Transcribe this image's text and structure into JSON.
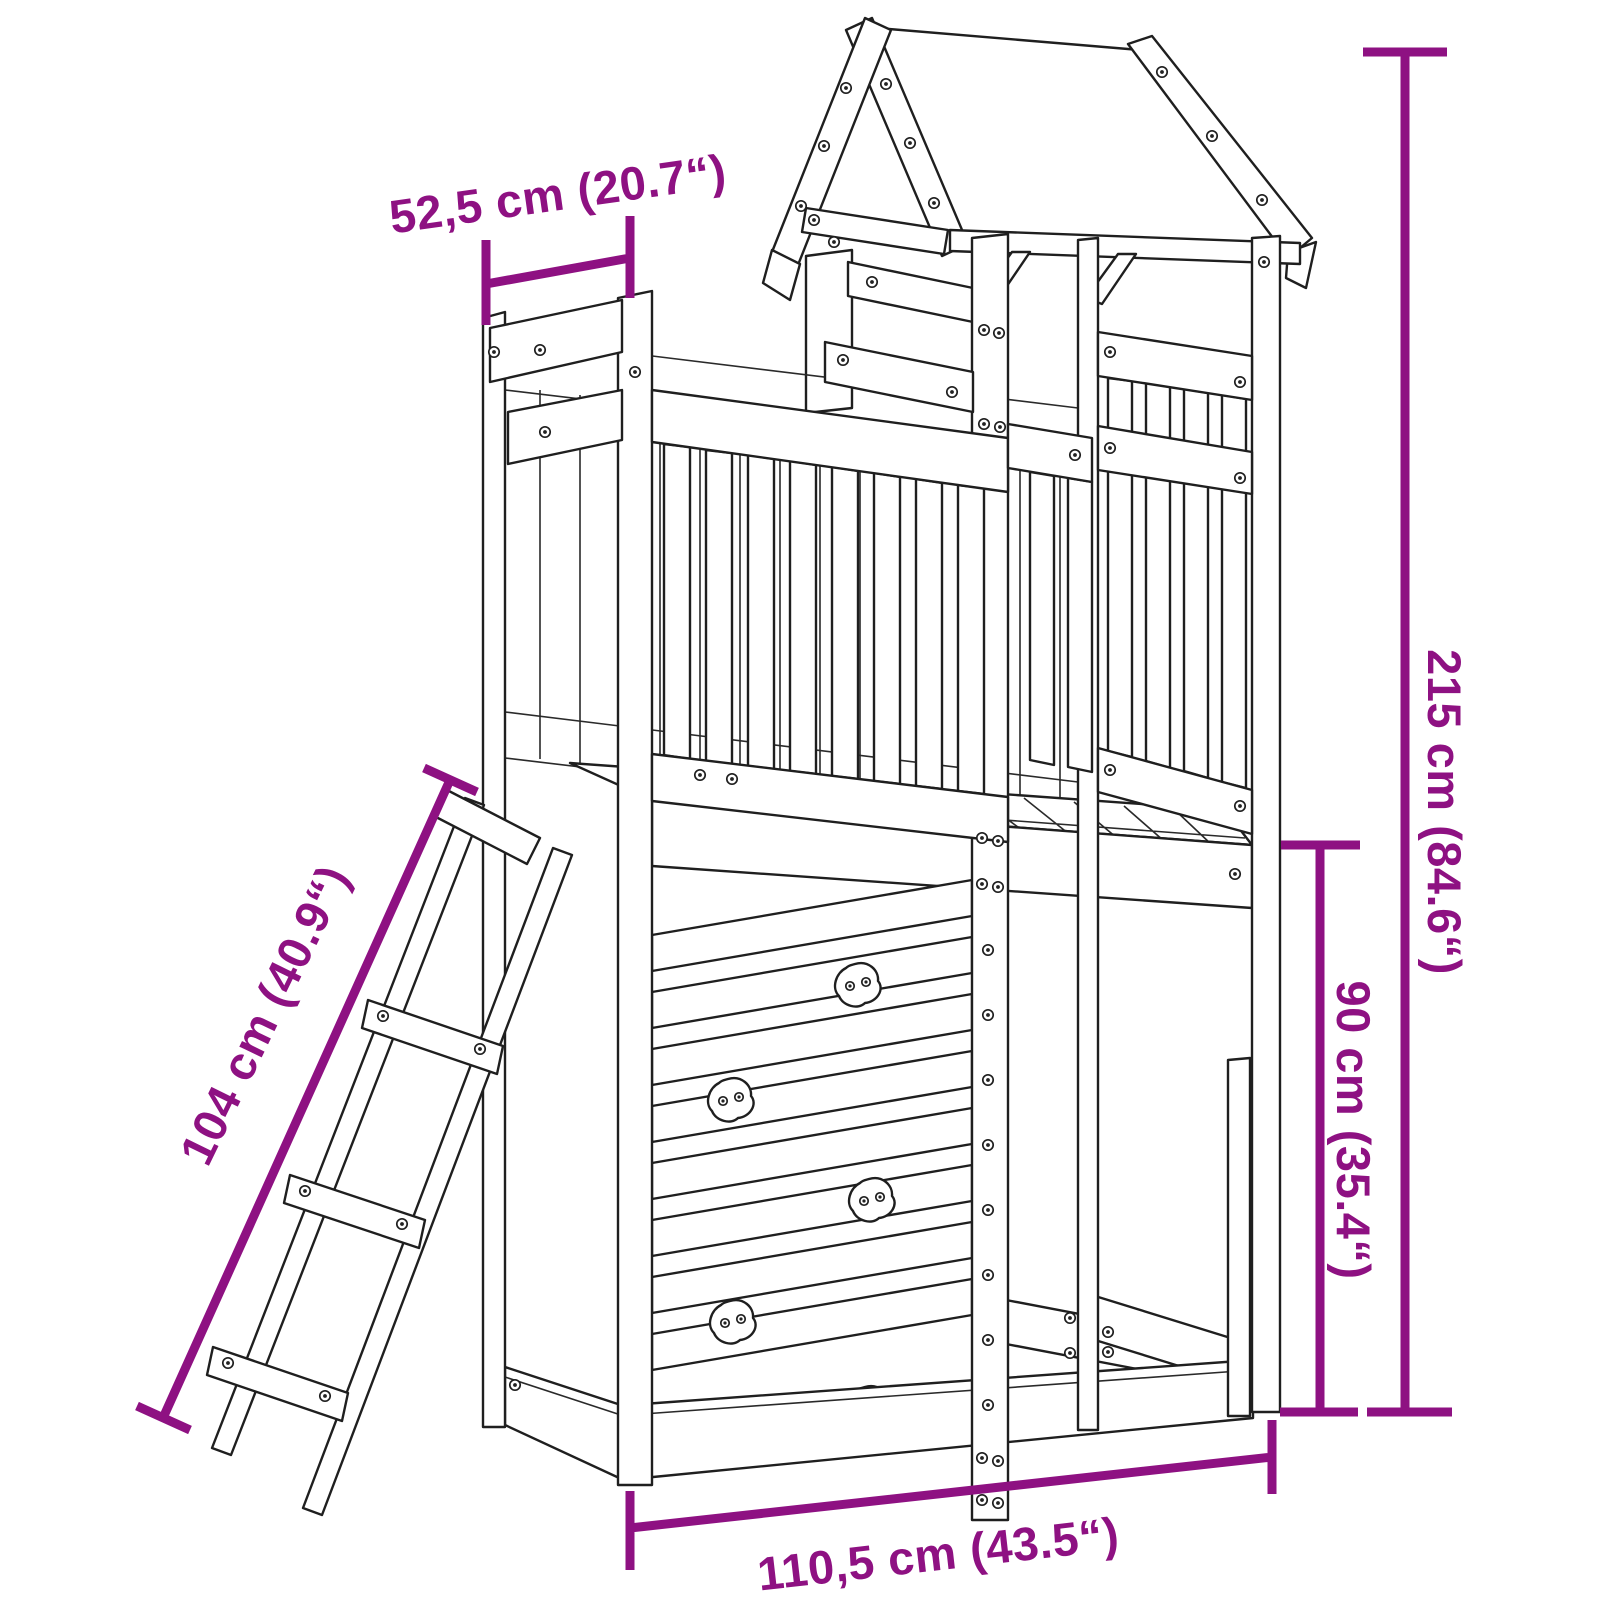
{
  "diagram": {
    "type": "product-dimension-drawing",
    "subject": "wooden play tower with roof, balustrade, climbing wall, sandbox frame and leaning ladder",
    "background": "#ffffff",
    "accent_color": "#8E1182",
    "line_color": "#1f1f1f",
    "dimensions": {
      "side_depth": {
        "label": "52,5 cm (20.7“)",
        "measures": "platform side depth"
      },
      "total_height": {
        "label": "215 cm (84.6“)",
        "measures": "total height"
      },
      "platform_height": {
        "label": "90 cm (35.4“)",
        "measures": "height under platform"
      },
      "ladder_length": {
        "label": "104 cm (40.9“)",
        "measures": "ladder length"
      },
      "front_width": {
        "label": "110,5 cm (43.5“)",
        "measures": "front width"
      }
    }
  }
}
